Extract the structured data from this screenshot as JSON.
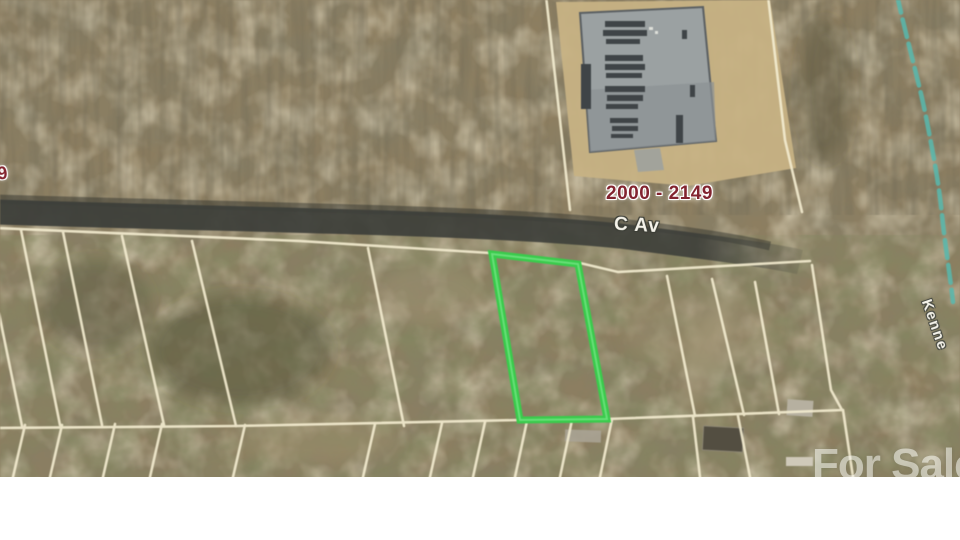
{
  "map": {
    "description": "Aerial parcel map with highlighted lot for sale",
    "labels": {
      "address_range": "2000 - 2149",
      "address_range_partial": "49",
      "street_name": "C Av",
      "street_name_right": "Kenne",
      "watermark": "For Sale"
    },
    "colors": {
      "terrain": "#8d7e60",
      "road": "#3d3f3a",
      "parcel": "#f2ebcf",
      "highlight": "#3acb4c",
      "highlightcore": "#8ef09c",
      "creek": "#57b9ae",
      "addrtext": "#82242f",
      "streettext": "#f5f3ea",
      "dirt": "#c7b284",
      "lot": "#9ba1a2",
      "trailer": "#3f4447",
      "watermarktext": "#f6f6f1"
    }
  }
}
